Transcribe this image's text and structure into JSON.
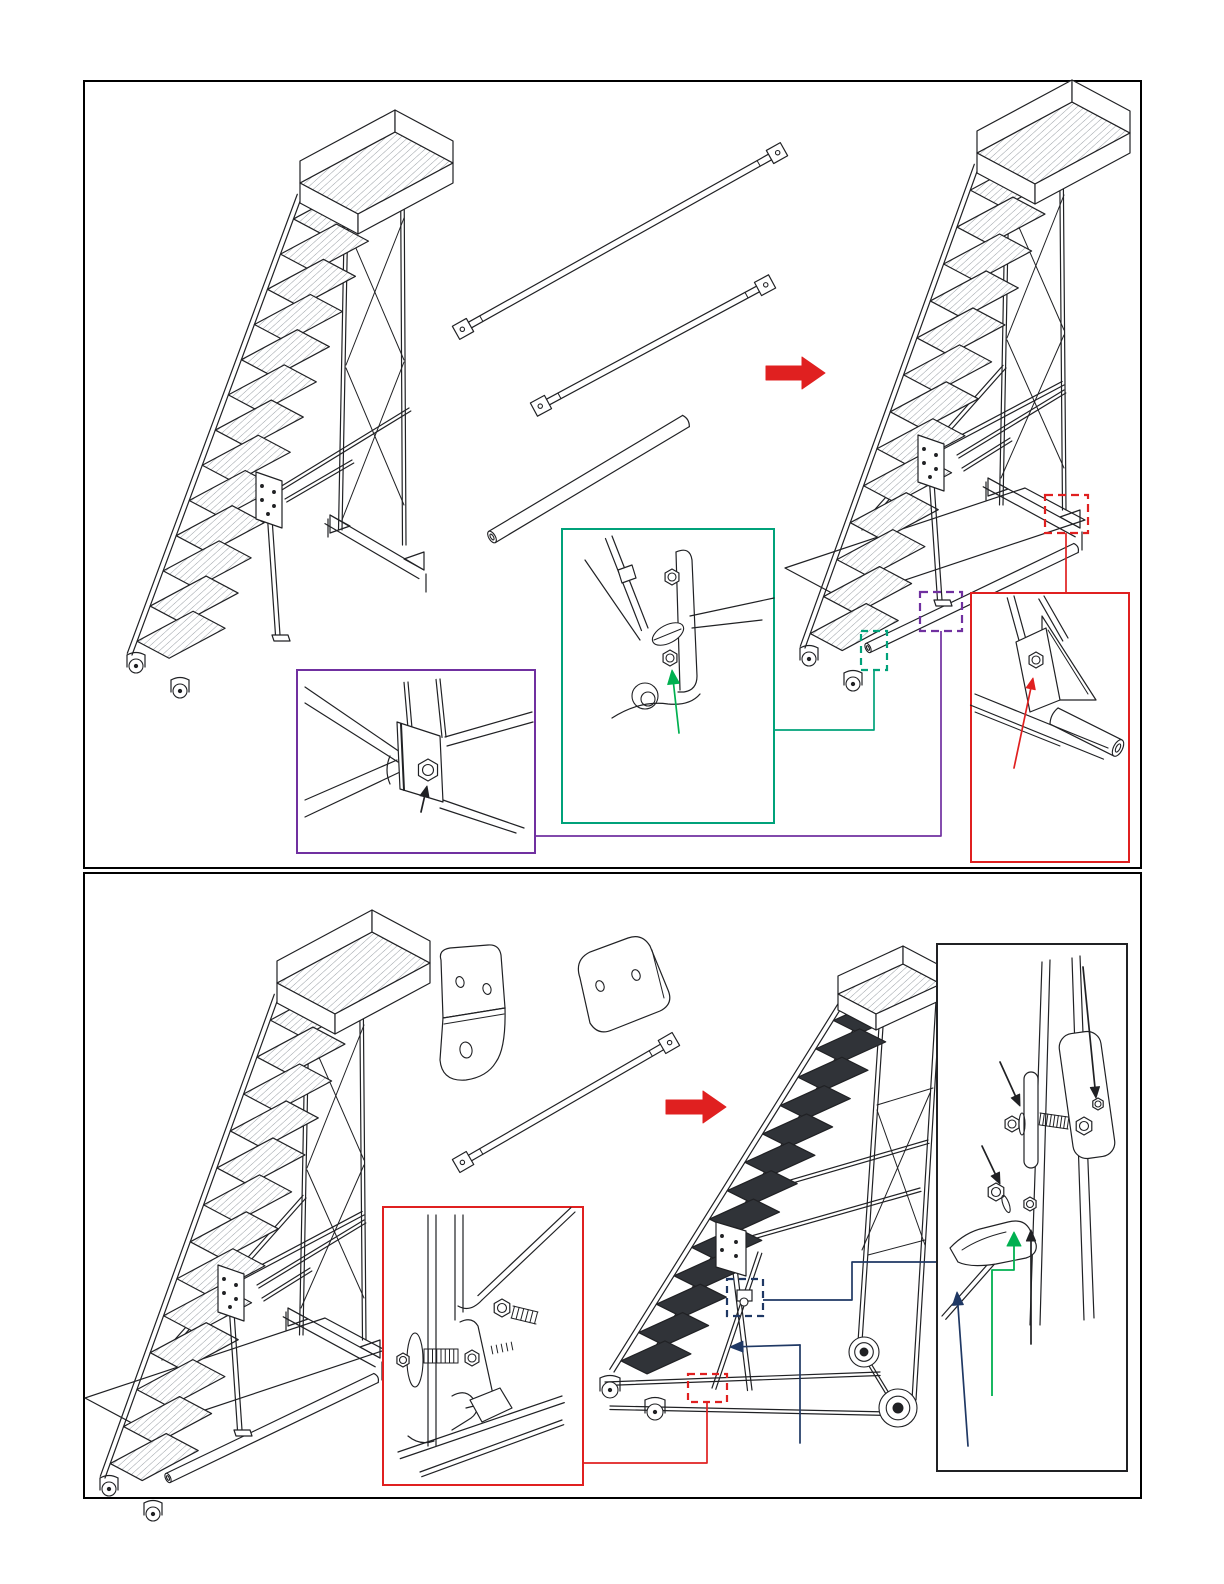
{
  "document": {
    "kind": "assembly-instruction-diagram",
    "subject": "rolling-warehouse-ladder",
    "visible_text": "none",
    "page_background": "#ffffff"
  },
  "colors": {
    "line": "#202124",
    "soft": "#8a9097",
    "panel_border": "#000000",
    "red": "#e02020",
    "purple": "#7030a0",
    "teal": "#00a27a",
    "green": "#00b050",
    "navy": "#1f3864",
    "tread_dark": "#303338",
    "white": "#ffffff"
  },
  "panel1": {
    "name": "brace-installation-step",
    "source_ladder": "ladder-without-diagonal-braces",
    "parts": [
      {
        "name": "diagonal-brace-long"
      },
      {
        "name": "diagonal-brace-short"
      },
      {
        "name": "round-cross-tube"
      }
    ],
    "transform_arrow": {
      "color_key": "red",
      "direction": "right"
    },
    "result_ladder": "ladder-with-braces-installed",
    "callouts": [
      {
        "name": "hinge-leg-foot-bolt-detail",
        "border_key": "purple",
        "pointer_key": "purple",
        "arrow_key": "line"
      },
      {
        "name": "front-foot-plate-bolts-detail",
        "border_key": "teal",
        "pointer_key": "teal",
        "arrow_key": "green"
      },
      {
        "name": "rear-foot-gusset-bolt-detail",
        "border_key": "red",
        "pointer_key": "red",
        "arrow_key": "red"
      }
    ]
  },
  "panel2": {
    "name": "tilt-back-transport-step",
    "source_ladder": "assembled-ladder-upright",
    "parts": [
      {
        "name": "bent-lock-bracket"
      },
      {
        "name": "flat-link-plate"
      },
      {
        "name": "diagonal-brace"
      }
    ],
    "transform_arrow": {
      "color_key": "red",
      "direction": "right"
    },
    "result_ladder": "ladder-tilted-on-transport-wheels",
    "callouts": [
      {
        "name": "strut-spring-bolt-detail",
        "border_key": "red",
        "pointer_key": "red",
        "arrow_key": "line"
      },
      {
        "name": "leg-clamp-bolt-detail",
        "border_key": "line",
        "pointer_key": "navy",
        "arrow_keys": [
          "line",
          "green",
          "navy"
        ]
      }
    ]
  }
}
